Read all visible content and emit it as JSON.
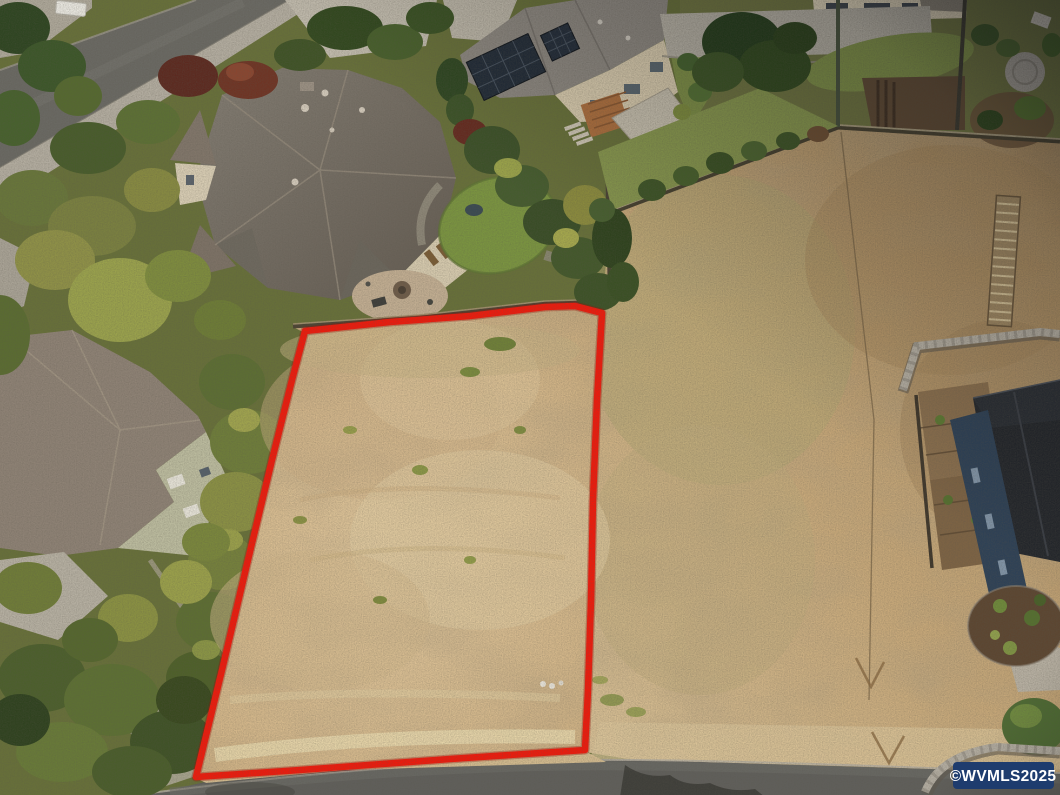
{
  "watermark": {
    "text": "©WVMLS2025",
    "background_color": "#1e3c6e",
    "text_color": "#ffffff"
  },
  "lot_boundary": {
    "stroke_color": "#ee1a0c",
    "glow_color": "#9e0d04"
  },
  "palette": {
    "field_tan": "#c9ab7c",
    "lot_tan": "#d8bd92",
    "grass_green": "#6f7547",
    "asphalt_gray": "#615f5b",
    "roof_taupe": "#787369",
    "solar_panel_navy": "#222c38"
  }
}
